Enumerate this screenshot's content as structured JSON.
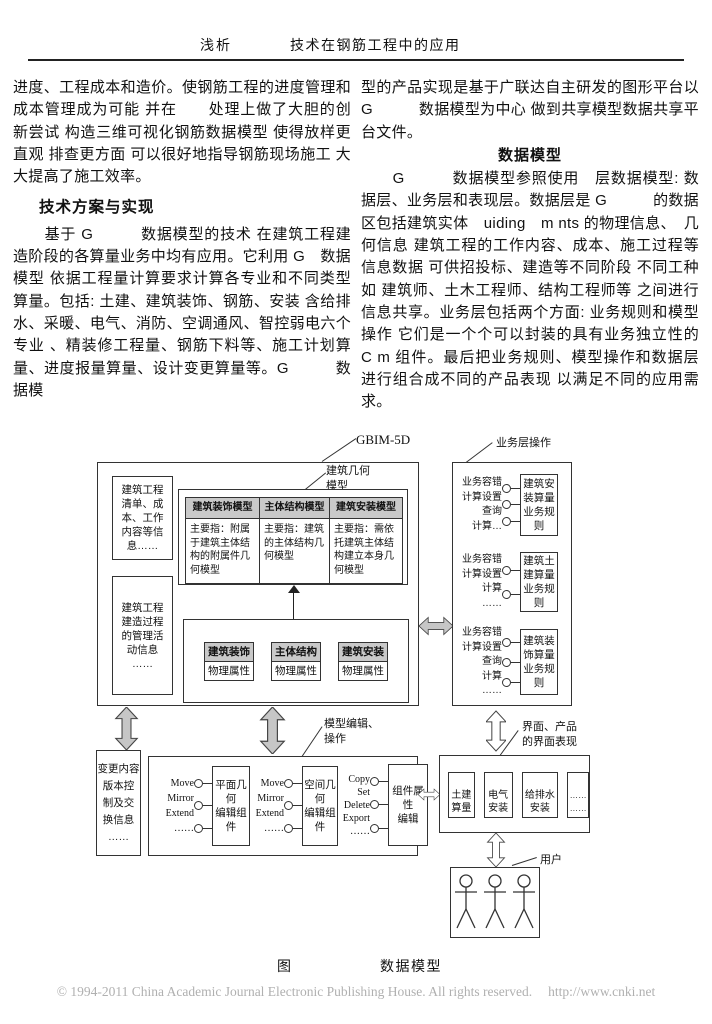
{
  "header": {
    "topic": "浅析",
    "title": "技术在钢筋工程中的应用"
  },
  "article": {
    "left_para1": "进度、工程成本和造价。使钢筋工程的进度管理和成本管理成为可能 并在　　处理上做了大胆的创新尝试 构造三维可视化钢筋数据模型 使得放样更直观 排查更方面 可以很好地指导钢筋现场施工 大大提高了施工效率。",
    "left_heading": "技术方案与实现",
    "left_para2": "　　基于 G　　　数据模型的技术 在建筑工程建造阶段的各算量业务中均有应用。它利用 G　数据模型 依据工程量计算要求计算各专业和不同类型算量。包括: 土建、建筑装饰、钢筋、安装 含给排水、采暖、电气、消防、空调通风、智控弱电六个专业 、精装修工程量、钢筋下料等、施工计划算量、进度报量算量、设计变更算量等。G　　　数据模",
    "right_para1": "型的产品实现是基于广联达自主研发的图形平台以 G　　　数据模型为中心 做到共享模型数据共享平台文件。",
    "right_heading": "数据模型",
    "right_para2": "　　G　　　数据模型参照使用　层数据模型: 数据层、业务层和表现层。数据层是 G　　　的数据区包括建筑实体　uiding　m nts 的物理信息、　几何信息 建筑工程的工作内容、成本、施工过程等信息数据 可供招投标、建造等不同阶段 不同工种 如 建筑师、土木工程师、结构工程师等 之间进行信息共享。业务层包括两个方面: 业务规则和模型操作 它们是一个个可以封装的具有业务独立性的 C m 组件。最后把业务规则、模型操作和数据层进行组合成不同的产品表现 以满足不同的应用需求。"
  },
  "diagram": {
    "gbim_label": "GBIM-5D",
    "geometry_model_label": "建筑几何\n模型",
    "project_info_box": "建筑工程\n清单、成\n本、工作\n内容等信\n息……",
    "management_info_box": "建筑工程\n建造过程\n的管理活\n动信息\n……",
    "model_table": {
      "headers": [
        "建筑装饰模型",
        "主体结构模型",
        "建筑安装模型"
      ],
      "cells": [
        "主要指：附属于建筑主体结构的附属件几何模型",
        "主要指：建筑的主体结构几何模型",
        "主要指：需依托建筑主体结构建立本身几何模型"
      ]
    },
    "physical": {
      "items": [
        {
          "title": "建筑装饰",
          "attr": "物理属性"
        },
        {
          "title": "主体结构",
          "attr": "物理属性"
        },
        {
          "title": "建筑安装",
          "attr": "物理属性"
        }
      ]
    },
    "business": {
      "label": "业务层操作",
      "groups": [
        {
          "ops": "业务容错\n计算设置\n查询\n计算…",
          "box": "建筑安\n装算量\n业务规\n则"
        },
        {
          "ops": "业务容错\n计算设置\n计算\n……",
          "box": "建筑土\n建算量\n业务规\n则"
        },
        {
          "ops": "业务容错\n计算设置\n查询\n计算\n……",
          "box": "建筑装\n饰算量\n业务规\n则"
        }
      ]
    },
    "change_box": "变更内容\n版本控\n制及交\n换信息\n……",
    "editor": {
      "label": "模型编辑、\n操作",
      "groups": [
        {
          "ops": "Move\nMirror\nExtend\n……",
          "box": "平面几\n何\n编辑组\n件"
        },
        {
          "ops": "Move\nMirror\nExtend\n……",
          "box": "空间几\n何\n编辑组\n件"
        },
        {
          "ops": "Copy\nSet\nDelete\nExport\n……",
          "box": "组件属\n性\n编辑"
        }
      ]
    },
    "ui_layer": {
      "label": "界面、产品\n的界面表现",
      "items": [
        "土建\n算量",
        "电气\n安装",
        "给排水\n安装",
        "……\n……"
      ]
    },
    "users_label": "用户"
  },
  "caption": {
    "fig": "图",
    "title": "数据模型"
  },
  "footer": {
    "copyright": "© 1994-2011 China Academic Journal Electronic Publishing House. All rights reserved.",
    "url": "http://www.cnki.net"
  }
}
